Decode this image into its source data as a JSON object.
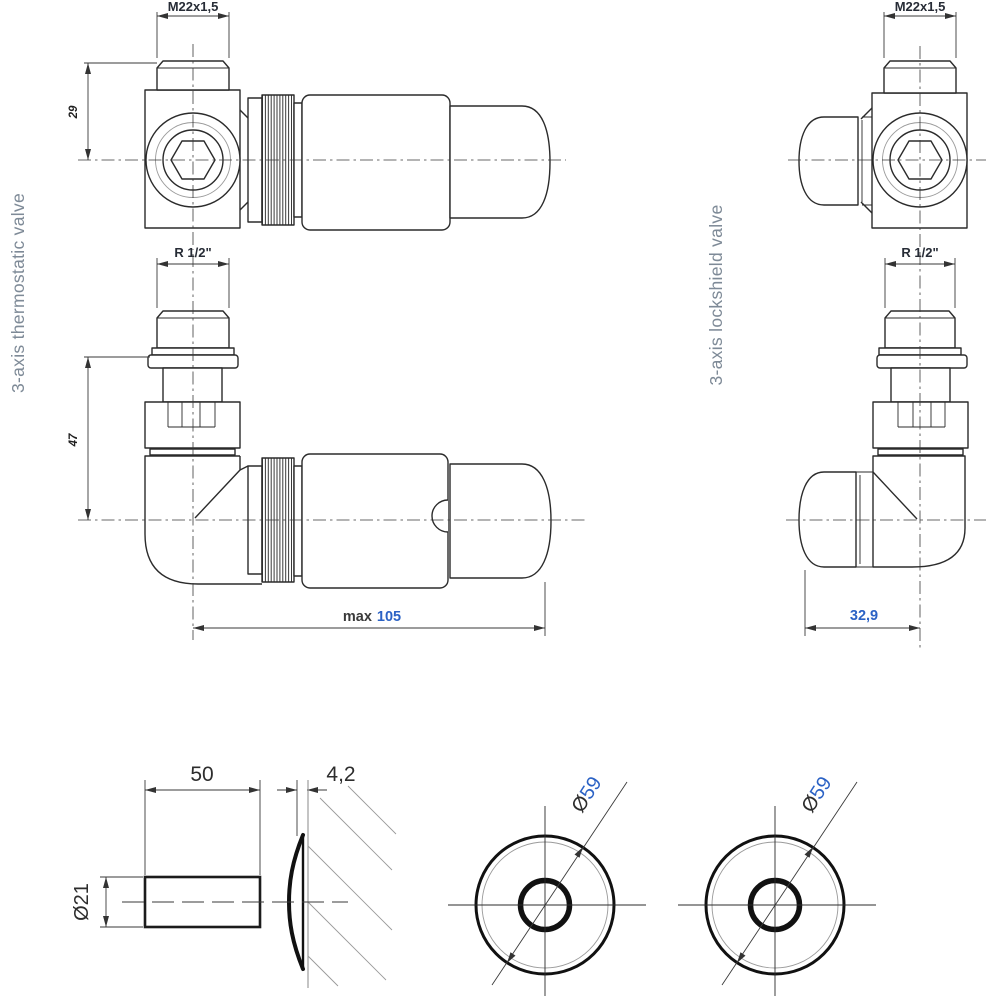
{
  "titles": {
    "left": "3-axis thermostatic valve",
    "right": "3-axis lockshield valve"
  },
  "dims": {
    "thread_m22": "M22x1,5",
    "thread_r12": "R 1/2\"",
    "height_head": "29",
    "height_valve": "47",
    "length_max_label": "max",
    "length_max_value": "105",
    "elbow_width": "32,9",
    "pipe_length": "50",
    "rosette_thickness": "4,2",
    "pipe_diameter": "Ø21",
    "rosette_dia_symbol": "Ø",
    "rosette_dia_value": "59"
  },
  "colors": {
    "accent_blue": "#2b62c5",
    "line": "#2b2b2b",
    "title_text": "#7e8a97"
  }
}
